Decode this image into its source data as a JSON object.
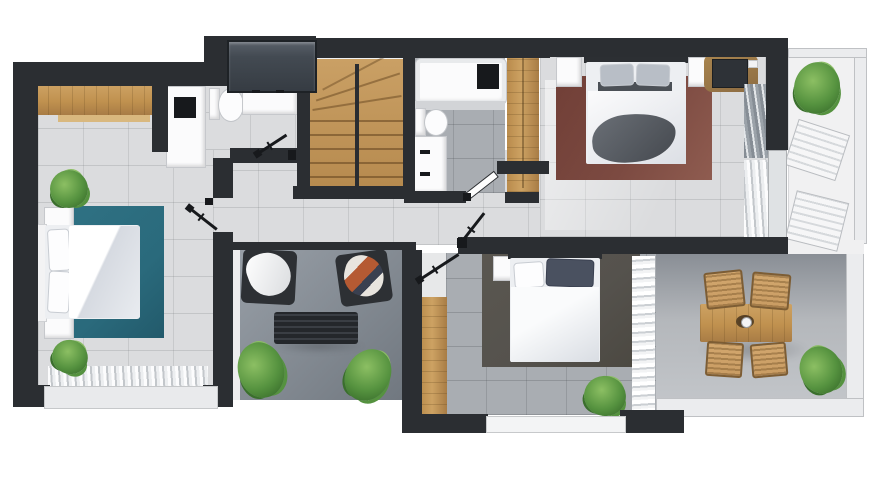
{
  "meta": {
    "title": "Top-down 3D render of an apartment floor plan (upper storey)",
    "canvas": {
      "width": 890,
      "height": 500
    }
  },
  "palette": {
    "wall": "#2b2e32",
    "floor_light": "#dbdcde",
    "floor_mid": "#a9adb2",
    "living1": "#99a0a8",
    "living2": "#6f767e",
    "terr1": "#f1f1f2",
    "terr2a": "#898e95",
    "terr2b": "#b4b7bb",
    "wood": "#c0914f",
    "wood_dark": "#a87c45",
    "teal": "#2a6a7c",
    "maroon": "#7c4a41",
    "rug3": "#55524d",
    "glass": "#434a52",
    "rattan": "#c99c63",
    "green": "#55923f",
    "green_l": "#8cbf63",
    "green_d": "#3a6f2c",
    "bedding": "#edeff2",
    "blanket": "#595e63"
  },
  "rooms": [
    {
      "name": "bedroom left",
      "items": [
        "wooden dresser",
        "double bed",
        "teal rug",
        "nightstand x2",
        "plant x2",
        "window curtain"
      ]
    },
    {
      "name": "bathroom 1",
      "items": [
        "glass shower",
        "shower cabin",
        "toilet",
        "double washbasin"
      ]
    },
    {
      "name": "staircase",
      "items": [
        "wooden winder stairs",
        "handrail"
      ]
    },
    {
      "name": "bathroom 2",
      "items": [
        "bathtub",
        "toilet",
        "washbasin vanity",
        "white door"
      ]
    },
    {
      "name": "bedroom right",
      "items": [
        "double bed",
        "maroon rug",
        "nightstand x2",
        "tv desk",
        "wardrobe",
        "curtains"
      ]
    },
    {
      "name": "terrace upper",
      "items": [
        "plant",
        "sun lounger x2"
      ]
    },
    {
      "name": "hallway",
      "items": [
        "door opening x4"
      ]
    },
    {
      "name": "lounge terrace",
      "items": [
        "armchair with white throw",
        "armchair with patterned throw",
        "slatted bench",
        "plant x2"
      ]
    },
    {
      "name": "bedroom bottom",
      "items": [
        "wardrobe",
        "double bed",
        "gray rug",
        "nightstand",
        "plant",
        "curtain wall",
        "window"
      ]
    },
    {
      "name": "terrace lower",
      "items": [
        "wooden dining table",
        "rattan chair x4",
        "plant"
      ]
    }
  ]
}
